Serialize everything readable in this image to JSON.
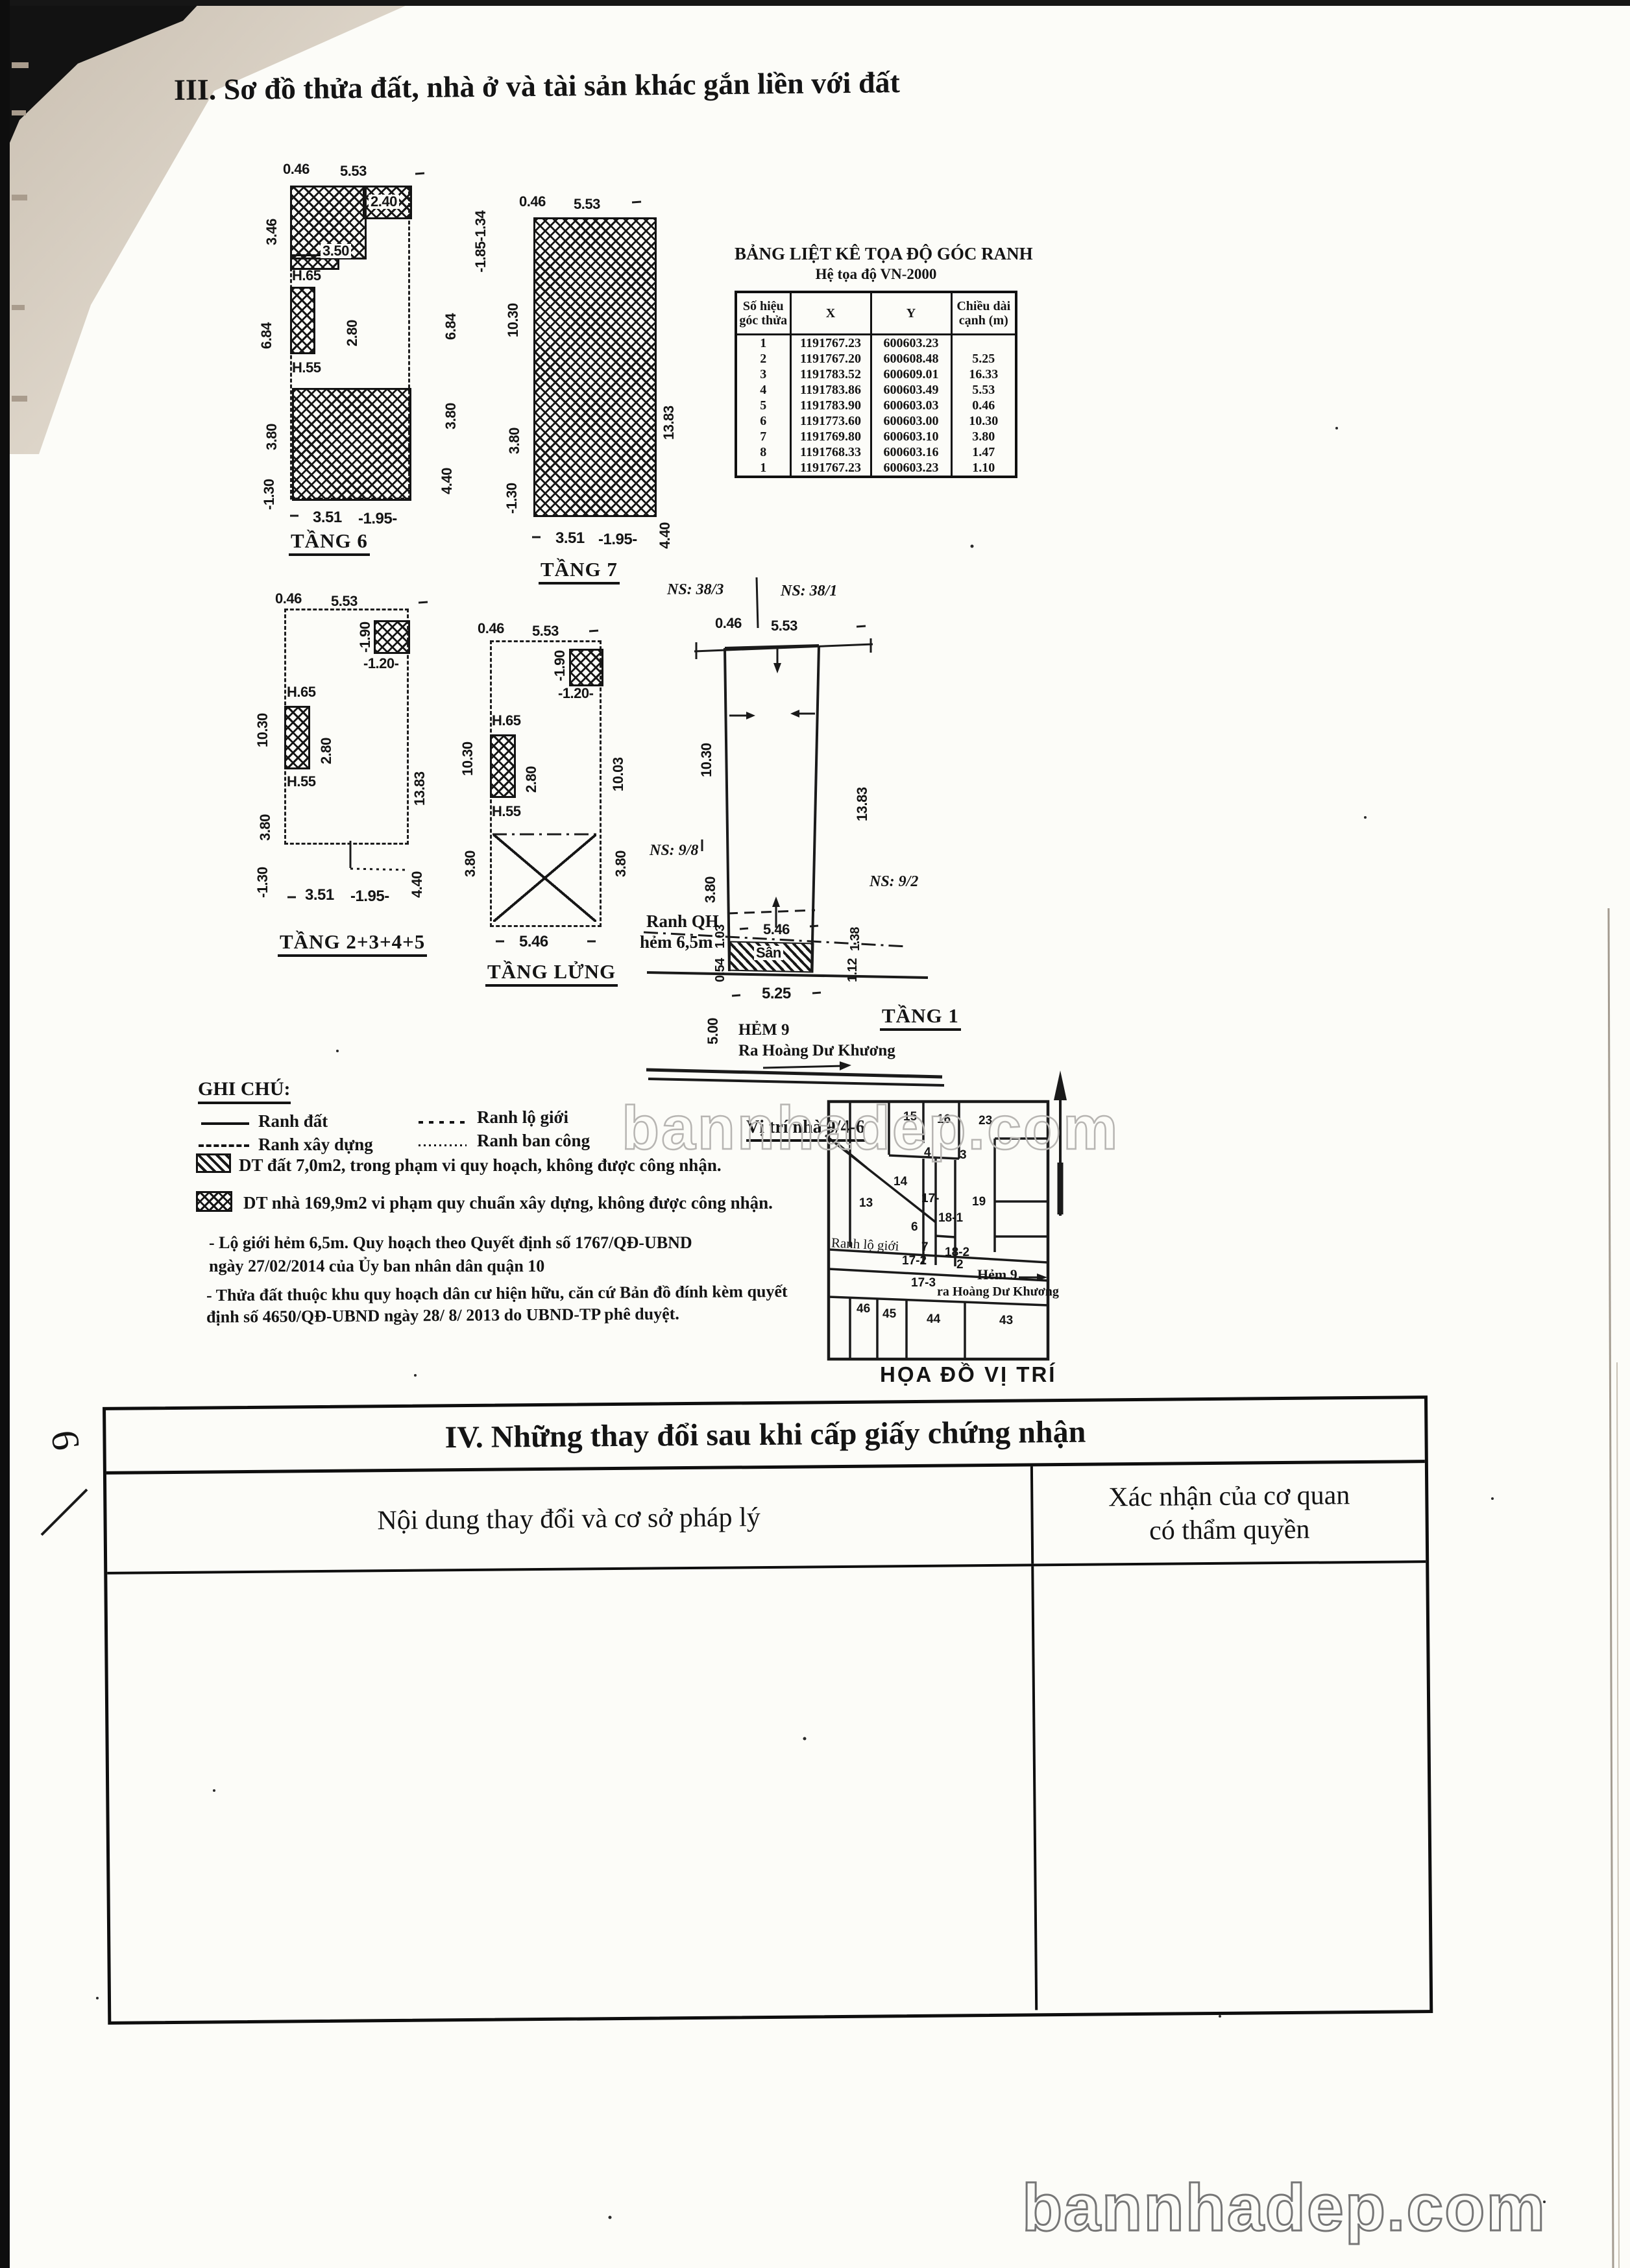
{
  "document": {
    "section3_title": "III. Sơ đồ thửa đất, nhà ở và tài sản khác gắn liền với đất",
    "watermark": "bannhadep.com",
    "handwritten_mark": "6"
  },
  "coord_table": {
    "title": "BẢNG LIỆT KÊ TỌA ĐỘ GÓC RANH",
    "subtitle": "Hệ tọa độ VN-2000",
    "headers": {
      "c1a": "Số hiệu",
      "c1b": "góc thửa",
      "c2": "X",
      "c3": "Y",
      "c4a": "Chiều dài",
      "c4b": "cạnh (m)"
    },
    "rows": [
      [
        "1",
        "1191767.23",
        "600603.23",
        ""
      ],
      [
        "2",
        "1191767.20",
        "600608.48",
        "5.25"
      ],
      [
        "3",
        "1191783.52",
        "600609.01",
        "16.33"
      ],
      [
        "4",
        "1191783.86",
        "600603.49",
        "5.53"
      ],
      [
        "5",
        "1191783.90",
        "600603.03",
        "0.46"
      ],
      [
        "6",
        "1191773.60",
        "600603.00",
        "10.30"
      ],
      [
        "7",
        "1191769.80",
        "600603.10",
        "3.80"
      ],
      [
        "8",
        "1191768.33",
        "600603.16",
        "1.47"
      ],
      [
        "1",
        "1191767.23",
        "600603.23",
        "1.10"
      ]
    ]
  },
  "floors": {
    "t6": {
      "name": "TẦNG 6",
      "d046": "0.46",
      "d553": "5.53",
      "l346": "3.46",
      "l684": "6.84",
      "l380": "3.80",
      "l130": "-1.30",
      "r185": "-1.85-1.34",
      "r684": "6.84",
      "r380": "3.80",
      "r440": "4.40",
      "b351": "3.51",
      "b195": "-1.95-",
      "i240": "2.40",
      "i350": "3.50",
      "i280": "2.80",
      "h65": "H.65",
      "h55": "H.55"
    },
    "t7": {
      "name": "TẦNG 7",
      "d046": "0.46",
      "d553": "5.53",
      "l1030": "10.30",
      "l380": "3.80",
      "l130": "-1.30",
      "r1383": "13.83",
      "r440": "4.40",
      "b351": "3.51",
      "b195": "-1.95-"
    },
    "t2345": {
      "name": "TẦNG 2+3+4+5",
      "d046": "0.46",
      "d553": "5.53",
      "l1030": "10.30",
      "l380": "3.80",
      "l130": "-1.30",
      "r1383": "13.83",
      "r440": "4.40",
      "b351": "3.51",
      "b195": "-1.95-",
      "i190": "-1.90",
      "i120": "-1.20-",
      "i280": "2.80",
      "h65": "H.65",
      "h55": "H.55"
    },
    "tlung": {
      "name": "TẦNG LỬNG",
      "d046": "0.46",
      "d553": "5.53",
      "l1030": "10.30",
      "l380": "3.80",
      "r1003": "10.03",
      "r380": "3.80",
      "b546": "5.46",
      "i190": "-1.90",
      "i120": "-1.20-",
      "i280": "2.80",
      "h65": "H.65",
      "h55": "H.55"
    },
    "t1": {
      "name": "TẦNG 1",
      "ns383": "NS: 38/3",
      "ns381": "NS: 38/1",
      "ns98": "NS: 9/8",
      "ns92": "NS: 9/2",
      "d046": "0.46",
      "d553": "5.53",
      "l1030": "10.30",
      "l380": "3.80",
      "r1383": "13.83",
      "d546": "5.46",
      "ranhqh1": "Ranh QH",
      "ranhqh2": "hẻm 6,5m",
      "san": "Sân",
      "l103": "1.03",
      "l054": "0.54",
      "r138": "1.38",
      "r112": "1.12",
      "d525": "5.25",
      "d500": "5.00",
      "hem": "HẺM 9",
      "ra": "Ra Hoàng Dư Khương"
    }
  },
  "legend": {
    "heading": "GHI CHÚ:",
    "items": [
      {
        "label": "Ranh đất"
      },
      {
        "label": "Ranh lộ giới"
      },
      {
        "label": "Ranh xây dựng"
      },
      {
        "label": "Ranh ban công"
      }
    ],
    "area1": "DT đất 7,0m2, trong phạm vi quy hoạch, không được công nhận.",
    "area2": "DT nhà 169,9m2 vi phạm quy chuẩn xây dựng, không được công nhận.",
    "notes": [
      "- Lộ giới hẻm 6,5m. Quy hoạch theo Quyết định số 1767/QĐ-UBND",
      "ngày 27/02/2014 của Ủy ban nhân dân quận 10",
      "- Thửa đất thuộc khu quy hoạch dân cư hiện hữu, căn cứ Bản đồ đính kèm quyết",
      "định số 4650/QĐ-UBND ngày 28/ 8/ 2013 do UBND-TP phê duyệt."
    ]
  },
  "map": {
    "title": "HỌA ĐỒ VỊ TRÍ",
    "vi_tri": "Vị trí nhà 9/4-6",
    "ranh_lo_gioi": "Ranh lộ giới",
    "hem9": "Hẻm 9",
    "ra_hoang": "ra Hoàng Dư Khương",
    "parcels": [
      "15",
      "16",
      "23",
      "13",
      "14",
      "4",
      "3",
      "19",
      "6",
      "17-",
      "18-1",
      "7",
      "18-2",
      "17-2",
      "2",
      "17-3",
      "46",
      "45",
      "44",
      "43"
    ]
  },
  "section4": {
    "title": "IV. Những thay đổi sau khi cấp giấy chứng nhận",
    "col1": "Nội dung thay đổi và cơ sở pháp lý",
    "col2a": "Xác nhận của cơ quan",
    "col2b": "có thẩm quyền"
  }
}
